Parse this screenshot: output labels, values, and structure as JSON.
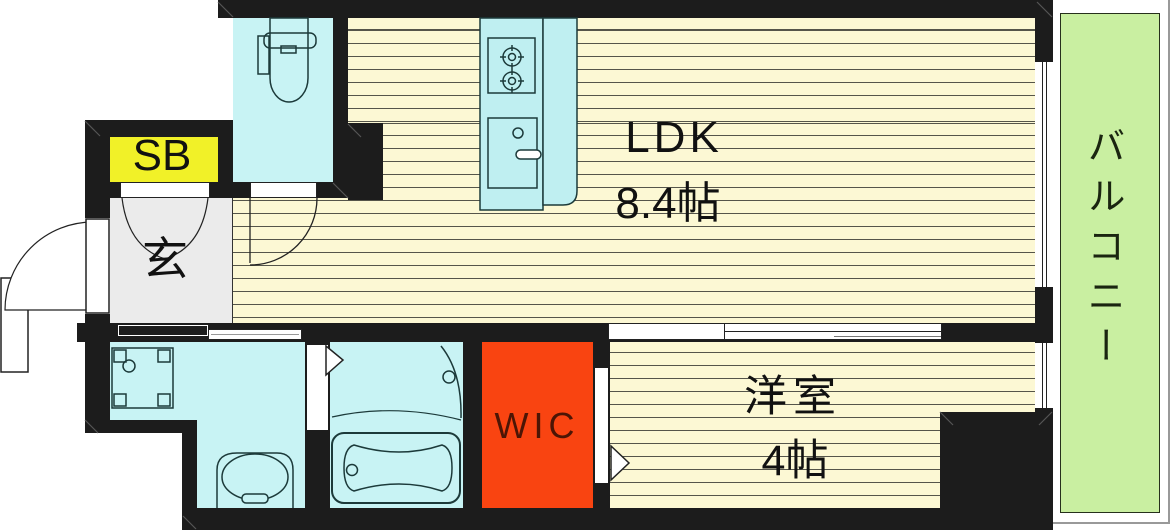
{
  "plan": {
    "title": "apartment-floor-plan",
    "rooms": {
      "ldk": {
        "label": "LDK",
        "size": "8.4帖"
      },
      "western_room": {
        "label": "洋室",
        "size": "4帖"
      },
      "wic": {
        "label": "WIC"
      },
      "shoe_box": {
        "label": "SB"
      },
      "entrance": {
        "label": "玄"
      },
      "balcony": {
        "label": "バルコニー"
      }
    },
    "colors": {
      "wall": "#1c1c1c",
      "floor": "#fcf8d4",
      "wet_area": "#c8f3f4",
      "kitchen_counter": "#bfeff1",
      "wic": "#f94411",
      "wic_text": "#4c1505",
      "shoe_box": "#f1f128",
      "balcony": "#c9efa1",
      "entrance_floor": "#ebebeb",
      "balcony_outline": "#999999"
    },
    "fixtures": [
      "toilet",
      "kitchen-stove",
      "kitchen-sink",
      "washing-machine-pan",
      "washbasin",
      "bathtub"
    ]
  }
}
